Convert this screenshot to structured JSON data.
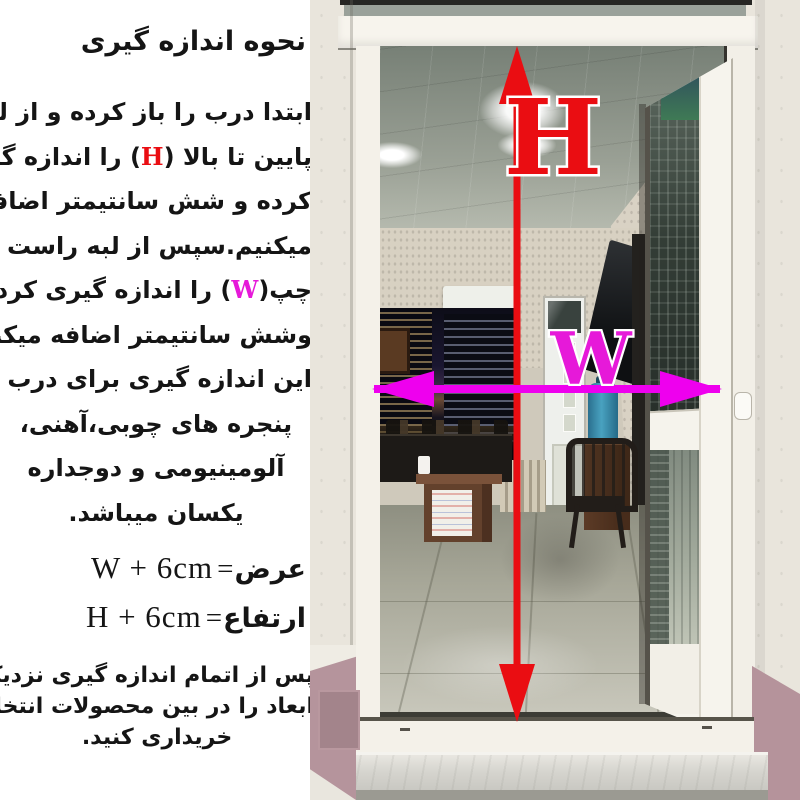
{
  "instructions": {
    "title": "نحوه اندازه گیری",
    "body_lines": [
      [
        {
          "t": "ابتدا درب را باز کرده و از لبه"
        }
      ],
      [
        {
          "t": "پایین تا بالا ("
        },
        {
          "t": "H",
          "c": "h"
        },
        {
          "t": ") را اندازه گیری"
        }
      ],
      [
        {
          "t": "کرده و شش سانتیمتر اضافه"
        }
      ],
      [
        {
          "t": "میکنیم.سپس از لبه راست تا"
        }
      ],
      [
        {
          "t": "چپ("
        },
        {
          "t": "W",
          "c": "w"
        },
        {
          "t": ") را اندازه گیری کرده"
        }
      ],
      [
        {
          "t": "وشش سانتیمتر اضافه میکنیم."
        }
      ],
      [
        {
          "t": "این اندازه گیری برای درب و"
        }
      ],
      [
        {
          "t": "پنجره های چوبی،آهنی،"
        }
      ],
      [
        {
          "t": "آلومینیومی و دوجداره"
        }
      ],
      [
        {
          "t": "یکسان میباشد."
        }
      ]
    ],
    "formulas": [
      {
        "label_fa": "عرض",
        "equals": "=",
        "expr": "W + 6cm"
      },
      {
        "label_fa": "ارتفاع",
        "equals": "=",
        "expr": "H + 6cm"
      }
    ],
    "footer_lines": [
      "پس از اتمام اندازه گیری نزدیکترین",
      "ابعاد را در بین محصولات انتخاب و",
      "خریداری کنید."
    ]
  },
  "diagram": {
    "height_label": "H",
    "width_label": "W",
    "colors": {
      "height": "#ea0d12",
      "width": "#e619d9",
      "width_arrow": "#ee00ee"
    }
  }
}
